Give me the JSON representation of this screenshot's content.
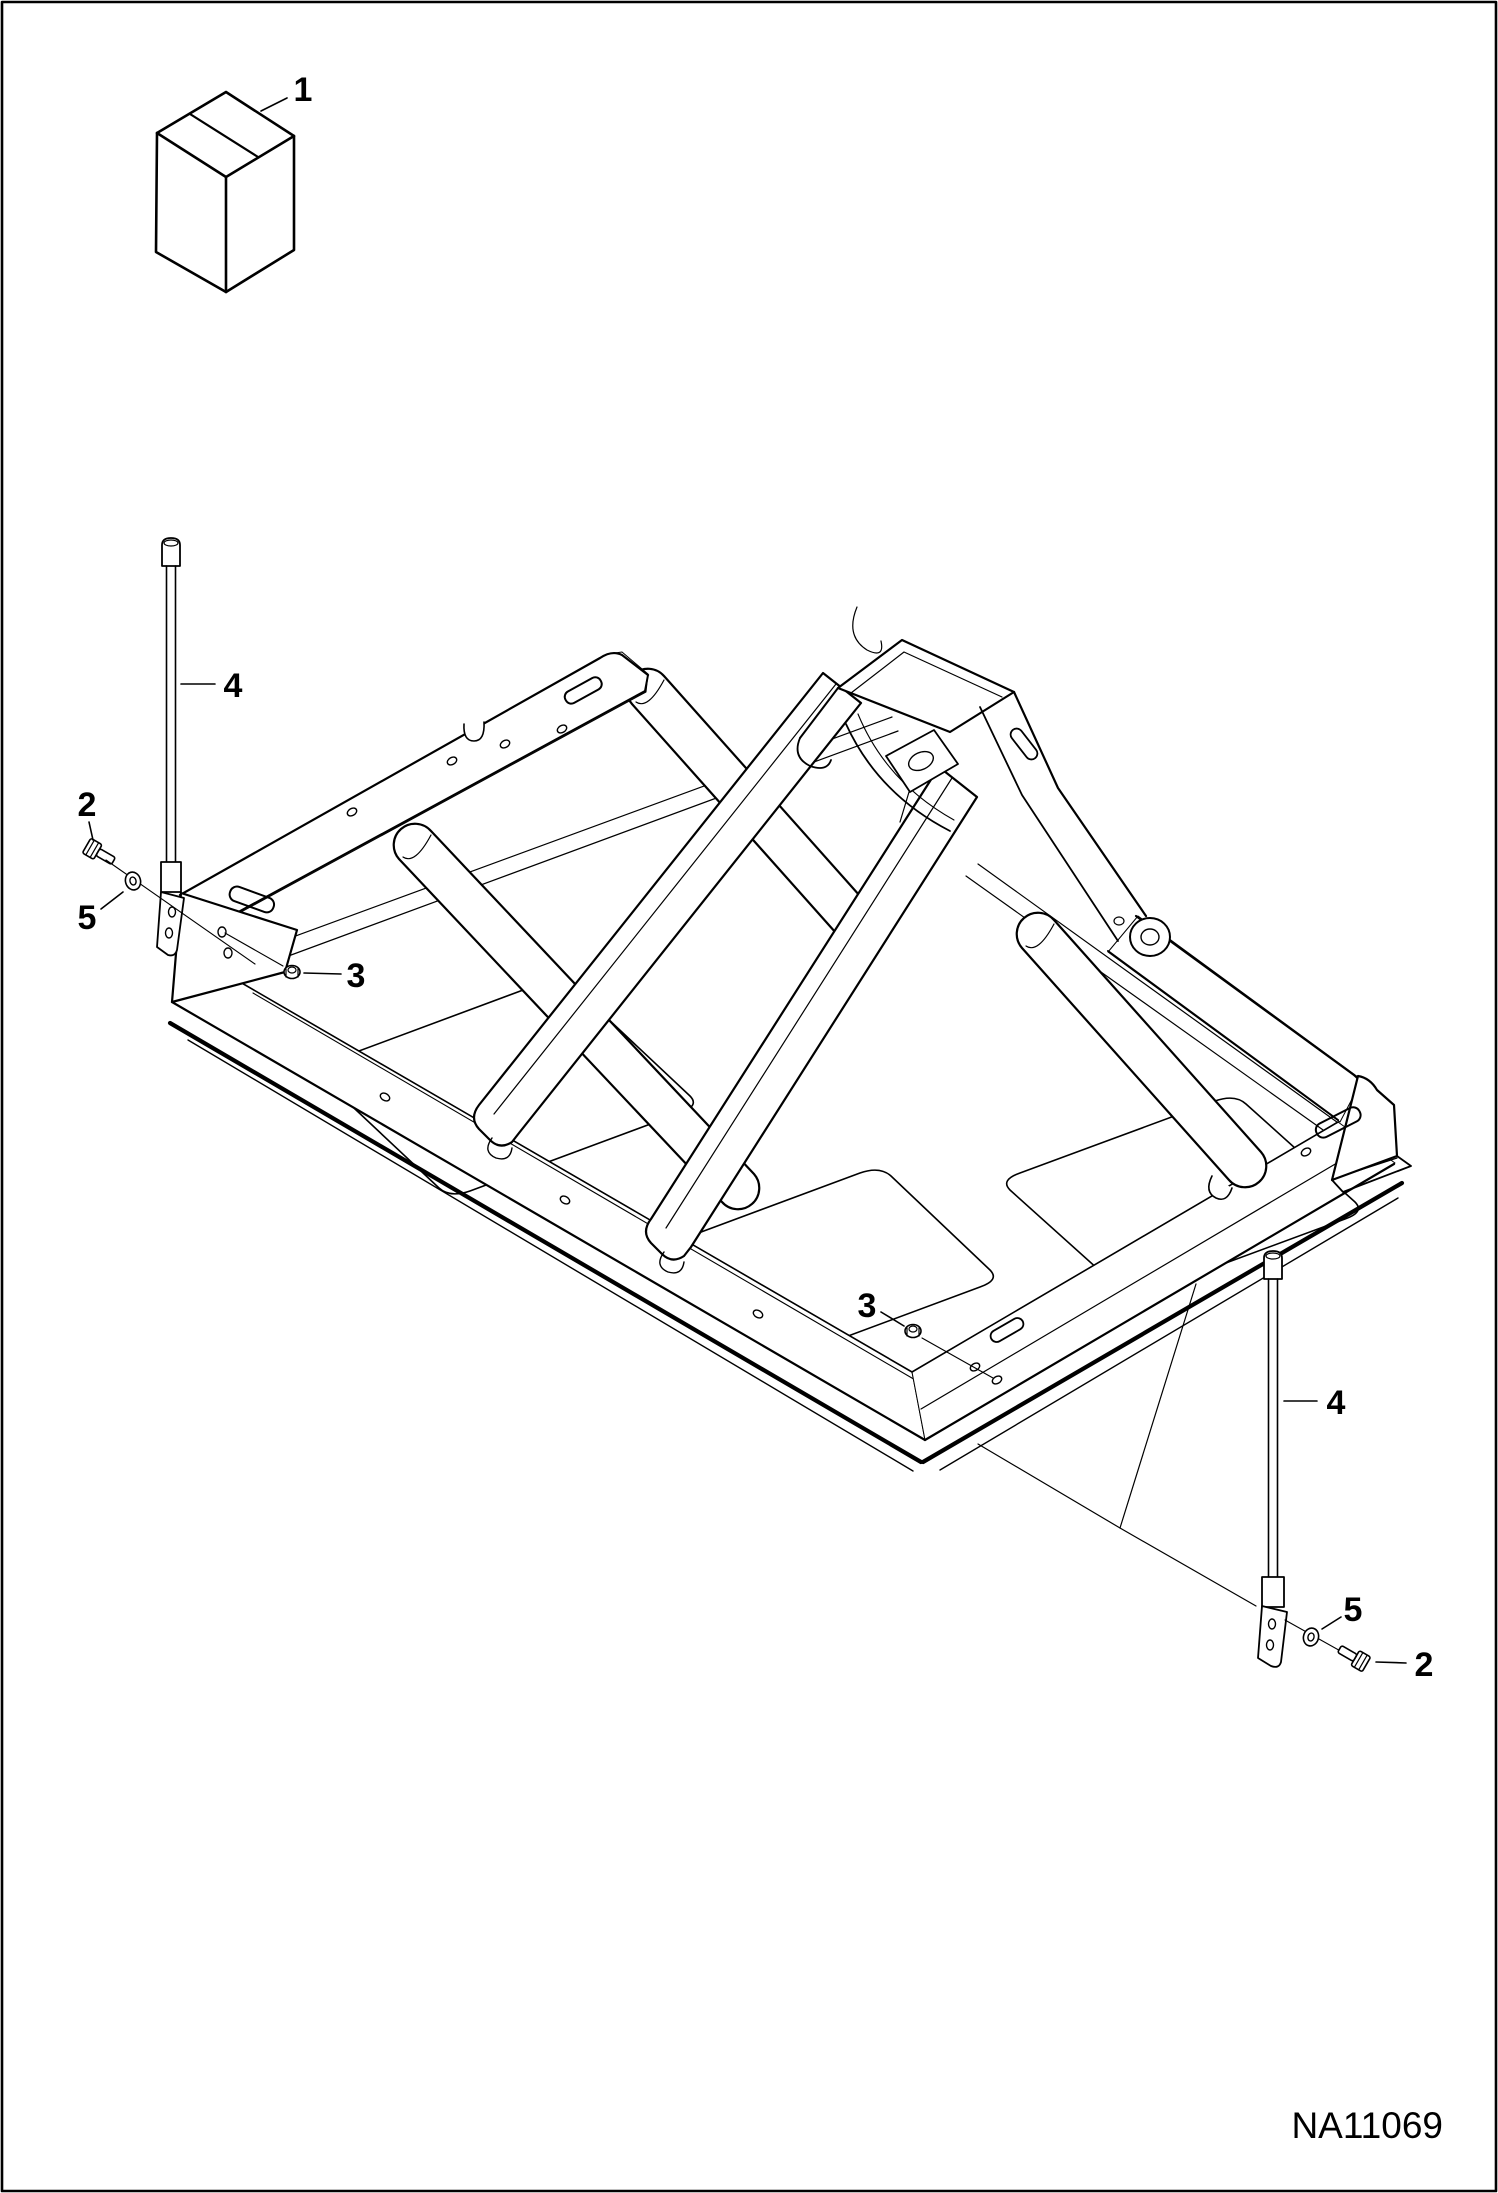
{
  "page": {
    "code": "NA11069"
  },
  "colors": {
    "ink": "#000000",
    "paper": "#ffffff"
  },
  "callouts": {
    "box": "1",
    "bolt_left": "2",
    "nut_left": "3",
    "rod_left": "4",
    "washer_left": "5",
    "nut_bottom": "3",
    "rod_right": "4",
    "washer_right": "5",
    "bolt_right": "2"
  }
}
